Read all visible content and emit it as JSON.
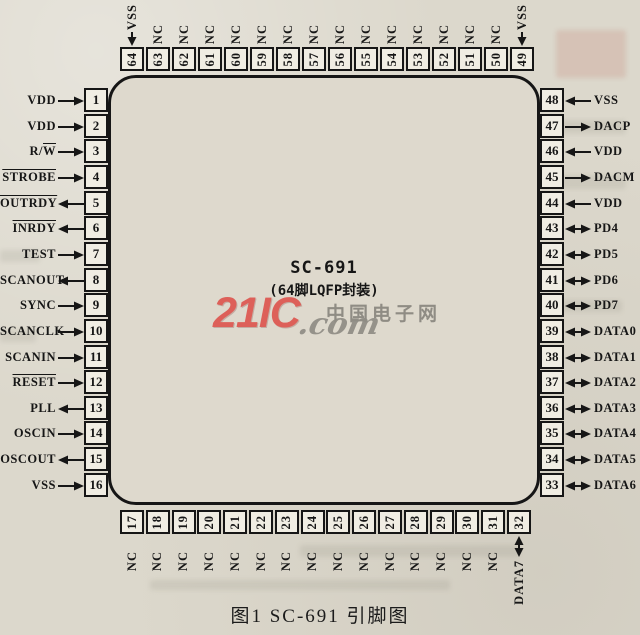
{
  "figure": {
    "chip_name": "SC-691",
    "package_label": "(64脚LQFP封装)",
    "caption": "图1  SC-691 引脚图"
  },
  "watermark": {
    "brand": "21IC",
    "domain_suffix": ".com",
    "site_name": "中国电子网",
    "brand_color": "#dd6059",
    "gray_color": "#8f8c84"
  },
  "colors": {
    "paper": "#dcd8cc",
    "ink": "#161616",
    "pin_fill": "#f0ede3"
  },
  "pins": {
    "left": [
      {
        "n": 1,
        "label": "VDD",
        "over": "",
        "dir": "in"
      },
      {
        "n": 2,
        "label": "VDD",
        "over": "",
        "dir": "in"
      },
      {
        "n": 3,
        "label": "R/W",
        "over": "W",
        "dir": "in"
      },
      {
        "n": 4,
        "label": "STROBE",
        "over": "STROBE",
        "dir": "in"
      },
      {
        "n": 5,
        "label": "OUTRDY",
        "over": "OUTRDY",
        "dir": "out"
      },
      {
        "n": 6,
        "label": "INRDY",
        "over": "INRDY",
        "dir": "out"
      },
      {
        "n": 7,
        "label": "TEST",
        "over": "",
        "dir": "in"
      },
      {
        "n": 8,
        "label": "SCANOUT",
        "over": "",
        "dir": "out"
      },
      {
        "n": 9,
        "label": "SYNC",
        "over": "",
        "dir": "in"
      },
      {
        "n": 10,
        "label": "SCANCLK",
        "over": "",
        "dir": "in"
      },
      {
        "n": 11,
        "label": "SCANIN",
        "over": "",
        "dir": "in"
      },
      {
        "n": 12,
        "label": "RESET",
        "over": "RESET",
        "dir": "in"
      },
      {
        "n": 13,
        "label": "PLL",
        "over": "",
        "dir": "out"
      },
      {
        "n": 14,
        "label": "OSCIN",
        "over": "",
        "dir": "in"
      },
      {
        "n": 15,
        "label": "OSCOUT",
        "over": "",
        "dir": "out"
      },
      {
        "n": 16,
        "label": "VSS",
        "over": "",
        "dir": "in"
      }
    ],
    "right": [
      {
        "n": 48,
        "label": "VSS",
        "over": "",
        "dir": "in"
      },
      {
        "n": 47,
        "label": "DACP",
        "over": "",
        "dir": "out"
      },
      {
        "n": 46,
        "label": "VDD",
        "over": "",
        "dir": "in"
      },
      {
        "n": 45,
        "label": "DACM",
        "over": "",
        "dir": "out"
      },
      {
        "n": 44,
        "label": "VDD",
        "over": "",
        "dir": "in"
      },
      {
        "n": 43,
        "label": "PD4",
        "over": "",
        "dir": "bi"
      },
      {
        "n": 42,
        "label": "PD5",
        "over": "",
        "dir": "bi"
      },
      {
        "n": 41,
        "label": "PD6",
        "over": "",
        "dir": "bi"
      },
      {
        "n": 40,
        "label": "PD7",
        "over": "",
        "dir": "bi"
      },
      {
        "n": 39,
        "label": "DATA0",
        "over": "",
        "dir": "bi"
      },
      {
        "n": 38,
        "label": "DATA1",
        "over": "",
        "dir": "bi"
      },
      {
        "n": 37,
        "label": "DATA2",
        "over": "",
        "dir": "bi"
      },
      {
        "n": 36,
        "label": "DATA3",
        "over": "",
        "dir": "bi"
      },
      {
        "n": 35,
        "label": "DATA4",
        "over": "",
        "dir": "bi"
      },
      {
        "n": 34,
        "label": "DATA5",
        "over": "",
        "dir": "bi"
      },
      {
        "n": 33,
        "label": "DATA6",
        "over": "",
        "dir": "bi"
      }
    ],
    "top": [
      {
        "n": 64,
        "label": "VSS",
        "over": "",
        "dir": "in"
      },
      {
        "n": 63,
        "label": "NC",
        "over": "",
        "dir": "none"
      },
      {
        "n": 62,
        "label": "NC",
        "over": "",
        "dir": "none"
      },
      {
        "n": 61,
        "label": "NC",
        "over": "",
        "dir": "none"
      },
      {
        "n": 60,
        "label": "NC",
        "over": "",
        "dir": "none"
      },
      {
        "n": 59,
        "label": "NC",
        "over": "",
        "dir": "none"
      },
      {
        "n": 58,
        "label": "NC",
        "over": "",
        "dir": "none"
      },
      {
        "n": 57,
        "label": "NC",
        "over": "",
        "dir": "none"
      },
      {
        "n": 56,
        "label": "NC",
        "over": "",
        "dir": "none"
      },
      {
        "n": 55,
        "label": "NC",
        "over": "",
        "dir": "none"
      },
      {
        "n": 54,
        "label": "NC",
        "over": "",
        "dir": "none"
      },
      {
        "n": 53,
        "label": "NC",
        "over": "",
        "dir": "none"
      },
      {
        "n": 52,
        "label": "NC",
        "over": "",
        "dir": "none"
      },
      {
        "n": 51,
        "label": "NC",
        "over": "",
        "dir": "none"
      },
      {
        "n": 50,
        "label": "NC",
        "over": "",
        "dir": "none"
      },
      {
        "n": 49,
        "label": "VSS",
        "over": "",
        "dir": "in"
      }
    ],
    "bottom": [
      {
        "n": 17,
        "label": "NC",
        "over": "",
        "dir": "none"
      },
      {
        "n": 18,
        "label": "NC",
        "over": "",
        "dir": "none"
      },
      {
        "n": 19,
        "label": "NC",
        "over": "",
        "dir": "none"
      },
      {
        "n": 20,
        "label": "NC",
        "over": "",
        "dir": "none"
      },
      {
        "n": 21,
        "label": "NC",
        "over": "",
        "dir": "none"
      },
      {
        "n": 22,
        "label": "NC",
        "over": "",
        "dir": "none"
      },
      {
        "n": 23,
        "label": "NC",
        "over": "",
        "dir": "none"
      },
      {
        "n": 24,
        "label": "NC",
        "over": "",
        "dir": "none"
      },
      {
        "n": 25,
        "label": "NC",
        "over": "",
        "dir": "none"
      },
      {
        "n": 26,
        "label": "NC",
        "over": "",
        "dir": "none"
      },
      {
        "n": 27,
        "label": "NC",
        "over": "",
        "dir": "none"
      },
      {
        "n": 28,
        "label": "NC",
        "over": "",
        "dir": "none"
      },
      {
        "n": 29,
        "label": "NC",
        "over": "",
        "dir": "none"
      },
      {
        "n": 30,
        "label": "NC",
        "over": "",
        "dir": "none"
      },
      {
        "n": 31,
        "label": "NC",
        "over": "",
        "dir": "none"
      },
      {
        "n": 32,
        "label": "DATA7",
        "over": "",
        "dir": "bi"
      }
    ]
  }
}
